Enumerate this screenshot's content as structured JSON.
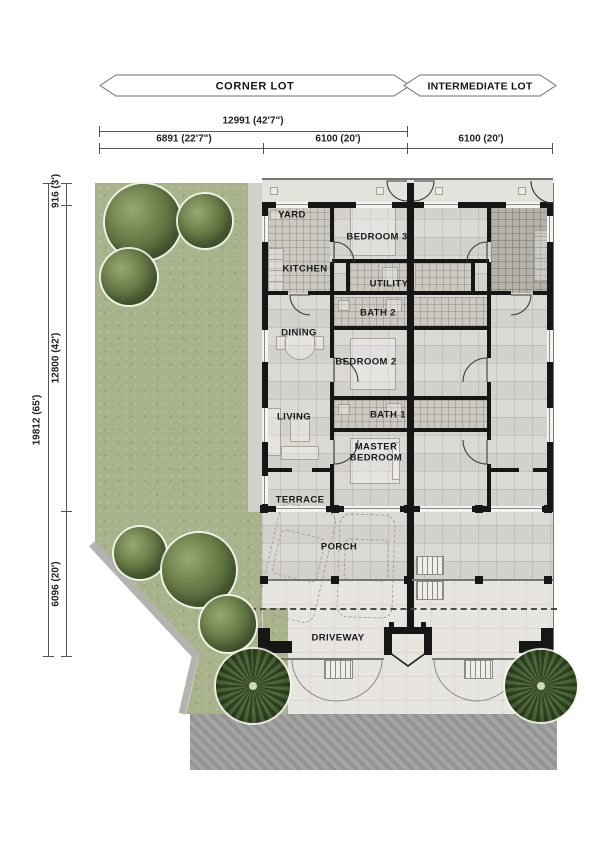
{
  "banners": {
    "corner": "CORNER LOT",
    "intermediate": "INTERMEDIATE LOT"
  },
  "dimensions": {
    "horizontal_total": "12991  (42'7\")",
    "horizontal_segments": [
      "6891  (22'7\")",
      "6100  (20')",
      "6100  (20')"
    ],
    "vertical_total": "19812  (65')",
    "vertical_segments": [
      "916  (3')",
      "12800  (42')",
      "6096  (20')"
    ]
  },
  "rooms": {
    "yard": "YARD",
    "kitchen": "KITCHEN",
    "bedroom3": "BEDROOM 3",
    "utility": "UTILITY",
    "bath2": "BATH 2",
    "dining": "DINING",
    "bedroom2": "BEDROOM 2",
    "living": "LIVING",
    "bath1": "BATH 1",
    "master": "MASTER\nBEDROOM",
    "terrace": "TERRACE",
    "porch": "PORCH",
    "driveway": "DRIVEWAY"
  },
  "colors": {
    "garden_green": "#a8b38b",
    "tree_green": "#52643a",
    "palm_green": "#2e4423",
    "floor_gray": "#dad8d2",
    "tile_gray": "#ccc9c2",
    "wall_black": "#161616",
    "road_gray": "#9d9d9b",
    "dimension_line": "#555555"
  }
}
